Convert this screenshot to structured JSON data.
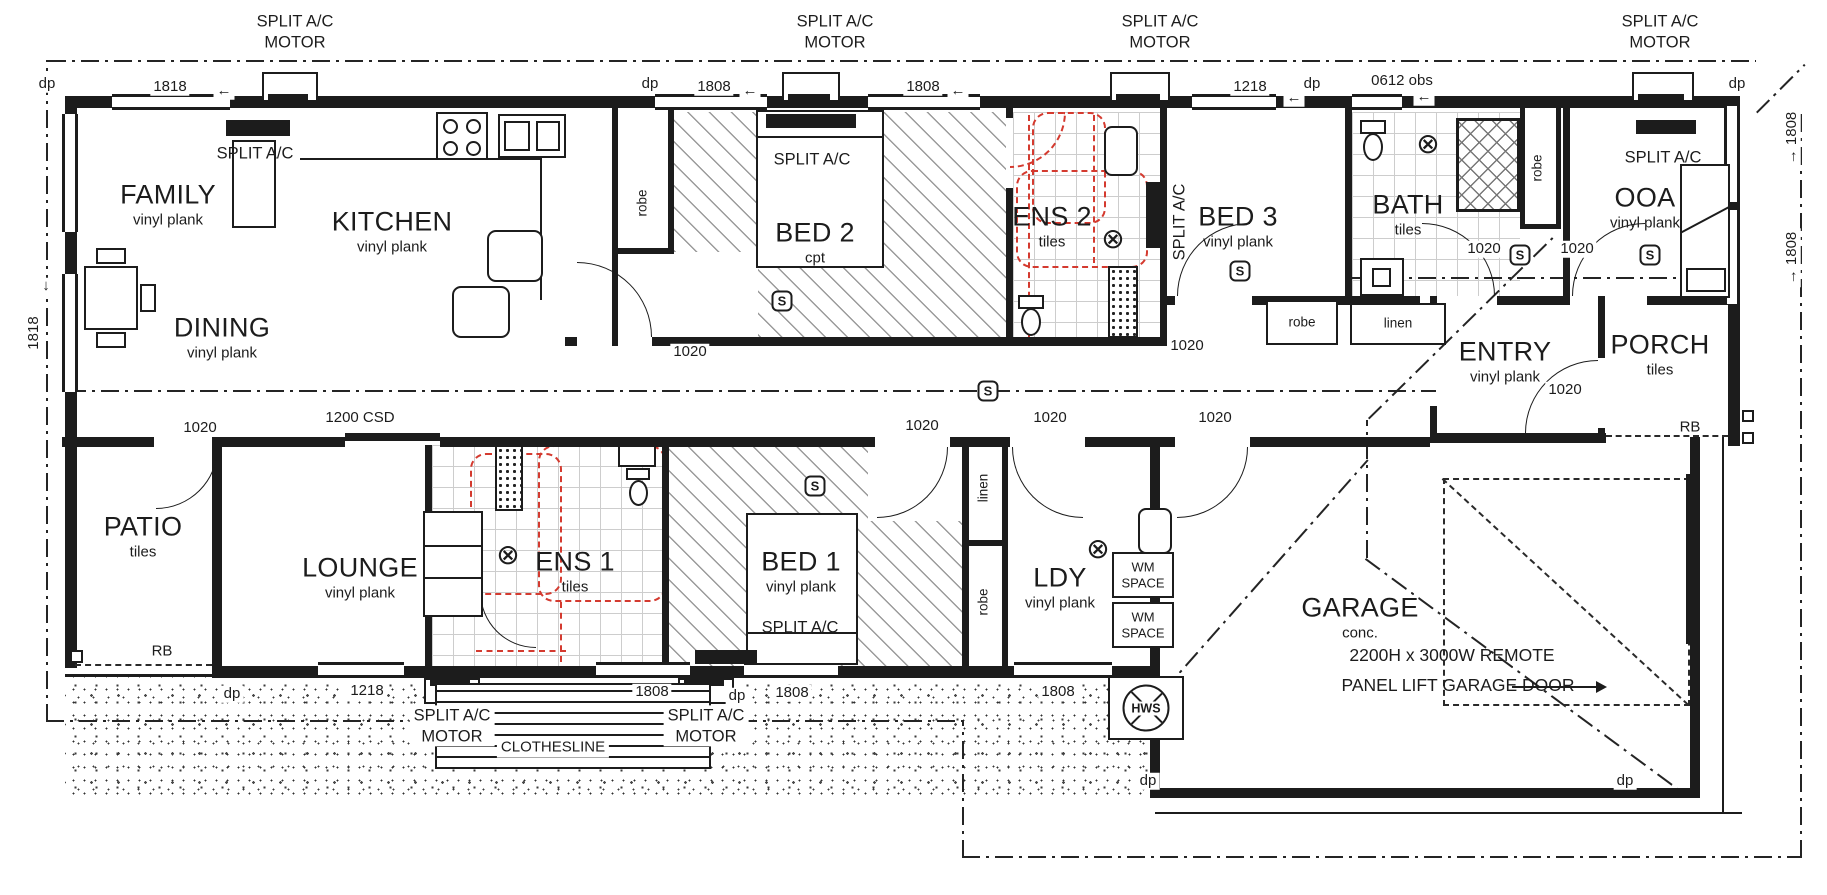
{
  "plan": {
    "width": 1827,
    "height": 895,
    "colors": {
      "line": "#1c1c1c",
      "red_dashed": "#d43a2f",
      "background": "#ffffff"
    },
    "rooms": [
      {
        "name": "FAMILY",
        "finish": "vinyl plank",
        "x": 168,
        "y": 205
      },
      {
        "name": "KITCHEN",
        "finish": "vinyl plank",
        "x": 392,
        "y": 232
      },
      {
        "name": "DINING",
        "finish": "vinyl plank",
        "x": 222,
        "y": 338
      },
      {
        "name": "BED 2",
        "finish": "cpt",
        "x": 815,
        "y": 243
      },
      {
        "name": "ENS 2",
        "finish": "tiles",
        "x": 1052,
        "y": 227
      },
      {
        "name": "BED 3",
        "finish": "vinyl plank",
        "x": 1238,
        "y": 227
      },
      {
        "name": "BATH",
        "finish": "tiles",
        "x": 1408,
        "y": 215
      },
      {
        "name": "OOA",
        "finish": "vinyl plank",
        "x": 1645,
        "y": 208
      },
      {
        "name": "ENTRY",
        "finish": "vinyl plank",
        "x": 1505,
        "y": 362
      },
      {
        "name": "PORCH",
        "finish": "tiles",
        "x": 1660,
        "y": 355
      },
      {
        "name": "PATIO",
        "finish": "tiles",
        "x": 143,
        "y": 537
      },
      {
        "name": "LOUNGE",
        "finish": "vinyl plank",
        "x": 360,
        "y": 578
      },
      {
        "name": "ENS 1",
        "finish": "tiles",
        "x": 575,
        "y": 572
      },
      {
        "name": "BED 1",
        "finish": "vinyl plank",
        "x": 801,
        "y": 572
      },
      {
        "name": "LDY",
        "finish": "vinyl plank",
        "x": 1060,
        "y": 588
      },
      {
        "name": "GARAGE",
        "finish": "conc.",
        "x": 1360,
        "y": 618
      }
    ],
    "dimensions": [
      {
        "text": "dp",
        "x": 47,
        "y": 84
      },
      {
        "text": "1818",
        "x": 170,
        "y": 87
      },
      {
        "text": "←",
        "x": 224,
        "y": 91
      },
      {
        "text": "dp",
        "x": 650,
        "y": 84
      },
      {
        "text": "1808",
        "x": 714,
        "y": 87
      },
      {
        "text": "←",
        "x": 750,
        "y": 91
      },
      {
        "text": "1808",
        "x": 923,
        "y": 87
      },
      {
        "text": "←",
        "x": 958,
        "y": 91
      },
      {
        "text": "1218",
        "x": 1250,
        "y": 87
      },
      {
        "text": "dp",
        "x": 1312,
        "y": 84
      },
      {
        "text": "←",
        "x": 1294,
        "y": 98
      },
      {
        "text": "0612 obs",
        "x": 1402,
        "y": 81
      },
      {
        "text": "←",
        "x": 1424,
        "y": 97
      },
      {
        "text": "dp",
        "x": 1737,
        "y": 84
      },
      {
        "text": "1818",
        "x": 34,
        "y": 333,
        "rot": -90
      },
      {
        "text": "↓",
        "x": 46,
        "y": 286
      },
      {
        "text": "→ 1808",
        "x": 1792,
        "y": 138,
        "rot": -90
      },
      {
        "text": "→ 1808",
        "x": 1792,
        "y": 258,
        "rot": -90
      },
      {
        "text": "1020",
        "x": 690,
        "y": 352
      },
      {
        "text": "1020",
        "x": 1187,
        "y": 346
      },
      {
        "text": "1020",
        "x": 200,
        "y": 428
      },
      {
        "text": "1200 CSD",
        "x": 360,
        "y": 418
      },
      {
        "text": "1020",
        "x": 922,
        "y": 426
      },
      {
        "text": "1020",
        "x": 1050,
        "y": 418
      },
      {
        "text": "1020",
        "x": 1215,
        "y": 418
      },
      {
        "text": "1020",
        "x": 1484,
        "y": 249
      },
      {
        "text": "1020",
        "x": 1577,
        "y": 249
      },
      {
        "text": "1020",
        "x": 1565,
        "y": 390
      },
      {
        "text": "dp",
        "x": 232,
        "y": 694
      },
      {
        "text": "1218",
        "x": 367,
        "y": 691
      },
      {
        "text": "1808",
        "x": 652,
        "y": 692
      },
      {
        "text": "dp",
        "x": 737,
        "y": 696
      },
      {
        "text": "1808",
        "x": 792,
        "y": 693
      },
      {
        "text": "1808",
        "x": 1058,
        "y": 692
      },
      {
        "text": "dp",
        "x": 1148,
        "y": 781
      },
      {
        "text": "dp",
        "x": 1625,
        "y": 781
      }
    ],
    "annotations": [
      {
        "text": "SPLIT A/C\nMOTOR",
        "x": 295,
        "y": 32,
        "cls": "acm"
      },
      {
        "text": "SPLIT A/C\nMOTOR",
        "x": 835,
        "y": 32,
        "cls": "acm"
      },
      {
        "text": "SPLIT A/C\nMOTOR",
        "x": 1160,
        "y": 32,
        "cls": "acm"
      },
      {
        "text": "SPLIT A/C\nMOTOR",
        "x": 1660,
        "y": 32,
        "cls": "acm"
      },
      {
        "text": "SPLIT A/C\nMOTOR",
        "x": 452,
        "y": 726,
        "cls": "acm"
      },
      {
        "text": "SPLIT A/C\nMOTOR",
        "x": 706,
        "y": 726,
        "cls": "acm"
      },
      {
        "text": "SPLIT A/C",
        "x": 255,
        "y": 154
      },
      {
        "text": "SPLIT A/C",
        "x": 812,
        "y": 160
      },
      {
        "text": "SPLIT A/C",
        "x": 1180,
        "y": 222,
        "rot": -90
      },
      {
        "text": "SPLIT A/C",
        "x": 1663,
        "y": 158
      },
      {
        "text": "SPLIT A/C",
        "x": 800,
        "y": 628
      },
      {
        "text": "robe",
        "x": 643,
        "y": 203,
        "rot": -90,
        "cls": "small"
      },
      {
        "text": "robe",
        "x": 1538,
        "y": 168,
        "rot": -90,
        "cls": "small"
      },
      {
        "text": "robe",
        "x": 1302,
        "y": 323,
        "cls": "small"
      },
      {
        "text": "linen",
        "x": 1398,
        "y": 324,
        "cls": "small"
      },
      {
        "text": "linen",
        "x": 984,
        "y": 488,
        "rot": -90,
        "cls": "small"
      },
      {
        "text": "robe",
        "x": 984,
        "y": 602,
        "rot": -90,
        "cls": "small"
      },
      {
        "text": "WM\nSPACE",
        "x": 1143,
        "y": 575,
        "cls": "wm"
      },
      {
        "text": "WM\nSPACE",
        "x": 1143,
        "y": 625,
        "cls": "wm"
      },
      {
        "text": "CLOTHESLINE",
        "x": 553,
        "y": 748,
        "cls": "clbl"
      },
      {
        "text": "RB",
        "x": 162,
        "y": 652,
        "cls": "rb"
      },
      {
        "text": "RB",
        "x": 1690,
        "y": 428,
        "cls": "rb"
      },
      {
        "text": "2200H x 3000W REMOTE",
        "x": 1452,
        "y": 656,
        "cls": "note"
      },
      {
        "text": "PANEL LIFT GARAGE DOOR",
        "x": 1458,
        "y": 686,
        "cls": "note"
      }
    ],
    "symbols": {
      "smoke_alarms": [
        {
          "x": 988,
          "y": 391
        },
        {
          "x": 782,
          "y": 301
        },
        {
          "x": 815,
          "y": 486
        },
        {
          "x": 1240,
          "y": 271
        },
        {
          "x": 1520,
          "y": 255
        },
        {
          "x": 1650,
          "y": 255
        }
      ],
      "lights": [
        {
          "x": 1113,
          "y": 239
        },
        {
          "x": 1428,
          "y": 144
        },
        {
          "x": 508,
          "y": 555
        },
        {
          "x": 1098,
          "y": 549
        }
      ],
      "hot_water_system": {
        "label": "HWS",
        "x": 1146,
        "y": 708
      }
    }
  }
}
